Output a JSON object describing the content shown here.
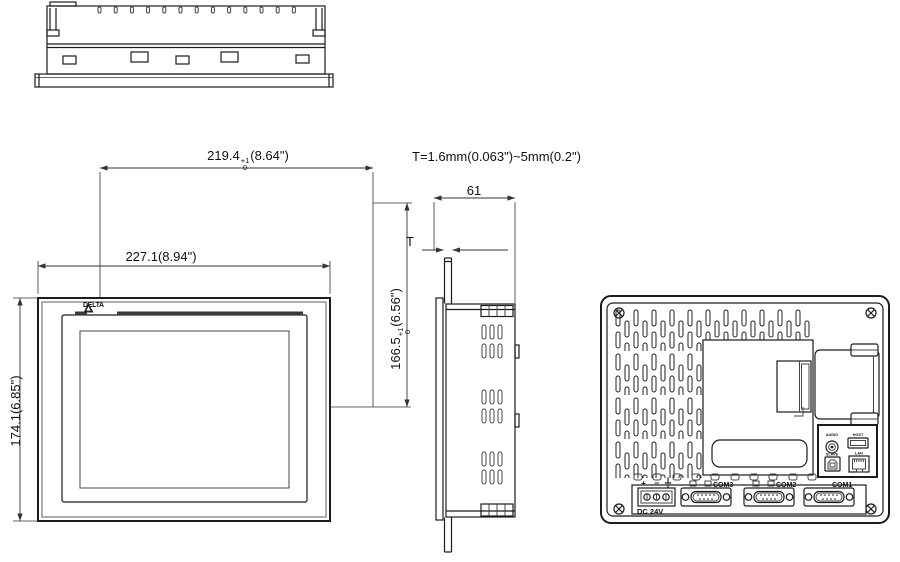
{
  "dims": {
    "cutout_width": {
      "value": "219.4",
      "tol_sup": "+1",
      "tol_sub": "0",
      "inches": "(8.64\")"
    },
    "outer_width": "227.1(8.94\")",
    "outer_height": "174.1(6.85\")",
    "cutout_height": {
      "value": "166.5",
      "tol_sup": "+1",
      "tol_sub": "0",
      "inches": "(6.56\")"
    },
    "depth": "61",
    "t_label": "T",
    "t_spec": "T=1.6mm(0.063\")~5mm(0.2\")"
  },
  "front": {
    "logo_text": "DELTA"
  },
  "rear": {
    "polarity": "+ −",
    "power_label": "DC 24V",
    "com_ports": [
      {
        "label": "COM3"
      },
      {
        "label": "COM2"
      },
      {
        "label": "COM1"
      }
    ],
    "io_labels": {
      "audio": "AUDIO",
      "usb_host": "HOST",
      "usb_slave": "SLAVE",
      "lan": "LAN"
    }
  }
}
